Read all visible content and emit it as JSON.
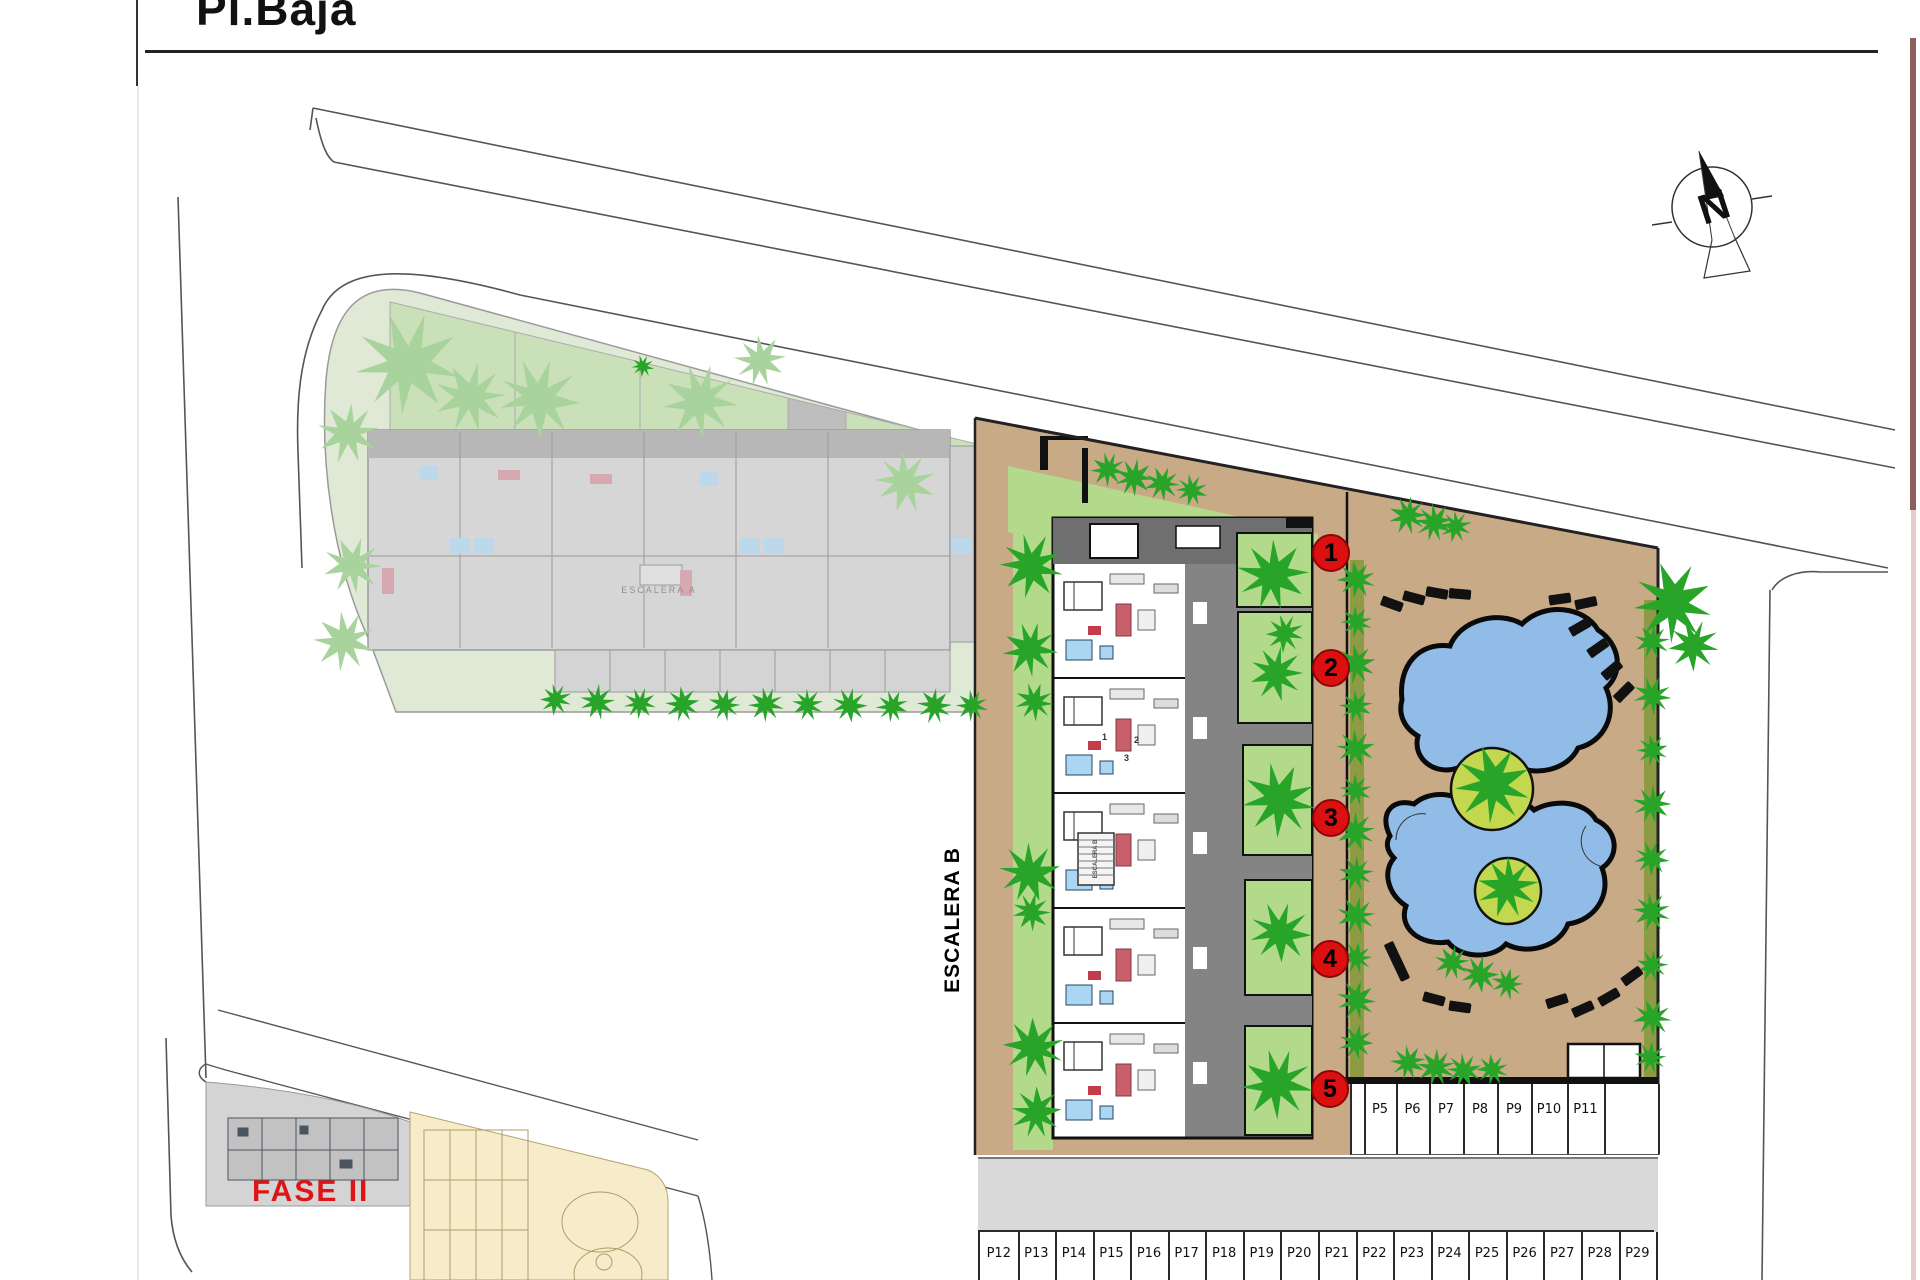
{
  "title": "Pl.Baja",
  "compass": {
    "letter": "N",
    "icon": "north-arrow-icon"
  },
  "plan": {
    "stair_b_label": "ESCALERA B",
    "stair_b_inner_label": "ESCALERA B",
    "stair_a_label": "ESCALERA A",
    "phase_label": "FASE II",
    "unit_badges": [
      "1",
      "2",
      "3",
      "4",
      "5"
    ],
    "unit_numbers": [
      "1",
      "2",
      "3"
    ]
  },
  "parking": {
    "right_row": [
      "P5",
      "P6",
      "P7",
      "P8",
      "P9",
      "P10",
      "P11"
    ],
    "bottom_row": [
      "P12",
      "P13",
      "P14",
      "P15",
      "P16",
      "P17",
      "P18",
      "P19",
      "P20",
      "P21",
      "P22",
      "P23",
      "P24",
      "P25",
      "P26",
      "P27",
      "P28",
      "P29"
    ]
  },
  "colors": {
    "badge_red": "#dc1010",
    "phase_red": "#df1414",
    "pool_blue": "#92bce8",
    "deck_tan": "#c9aa87",
    "garden_green": "#b3da8b",
    "hedge_green": "#28a428",
    "faded_lawn": "#dfe9d6",
    "road_gray": "#d9d9d9",
    "olive": "#8d9b45"
  }
}
